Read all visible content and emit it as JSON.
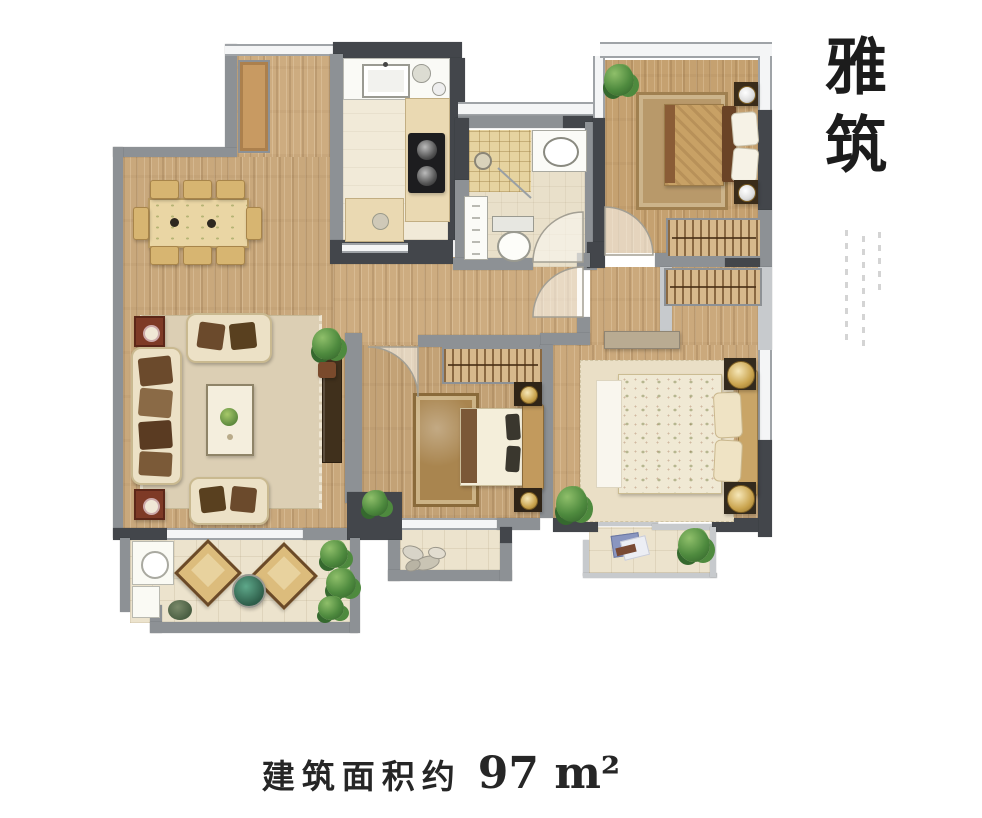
{
  "title": {
    "text": "雅筑"
  },
  "caption": {
    "label": "建筑面积约",
    "value": "97 m²"
  },
  "palette": {
    "wall_gray": "#8d9195",
    "wall_dark": "#43464b",
    "window_light": "#f4f5f6",
    "wood_floor": "#c9a87c",
    "kitchen_floor": "#f1ead8",
    "bathroom_tile": "#e6d3a0",
    "balcony_tile": "#ece3cd",
    "plant_green": "#4e8a3e",
    "text_color": "#1c1c1c"
  }
}
